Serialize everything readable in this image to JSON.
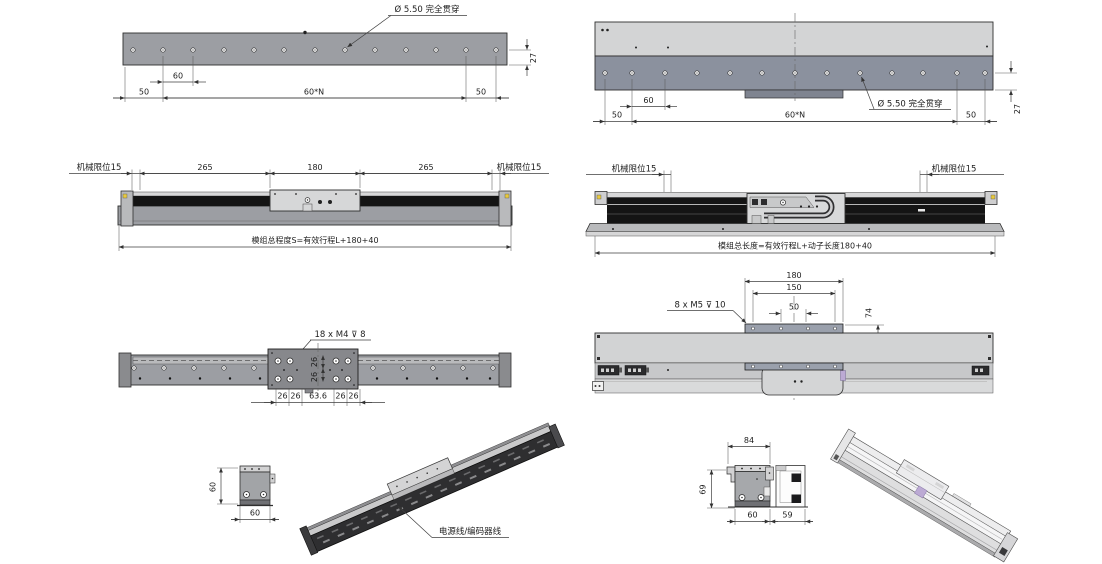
{
  "colors": {
    "body": "#9c9ea3",
    "slate": "#8b919e",
    "light": "#d3d4d5",
    "plate": "#9aa0ac",
    "rail_dark": "#141414",
    "carriage": "#d8d9da",
    "yellow": "#e8c93e",
    "purple": "#bcaad4",
    "iso_dark": "#2e2e30"
  },
  "views": {
    "plan_left": {
      "callout": "Ø 5.50 完全贯穿",
      "dim_pitch": "60",
      "dim_edge_left": "50",
      "dim_total": "60*N",
      "dim_edge_right": "50",
      "dim_height": "27"
    },
    "side_left": {
      "limit_left": "机械限位15",
      "limit_right": "机械限位15",
      "dim_a": "265",
      "dim_b": "180",
      "dim_c": "265",
      "total_note": "模组总程度S=有效行程L+180+40"
    },
    "bottom_left": {
      "callout": "18 x M4 ⊽ 8",
      "dim_1": "26",
      "dim_2": "26",
      "dim_3": "63.6",
      "dim_4": "26",
      "dim_5": "26",
      "dim_v1": "26",
      "dim_v2": "26"
    },
    "end_left": {
      "dim_height": "60",
      "dim_width": "60"
    },
    "iso_left": {
      "callout": "电源线/编码器线"
    },
    "plan_right": {
      "callout": "Ø 5.50 完全贯穿",
      "dim_pitch": "60",
      "dim_edge_left": "50",
      "dim_total": "60*N",
      "dim_edge_right": "50",
      "dim_height": "27"
    },
    "side_right": {
      "limit_left": "机械限位15",
      "limit_right": "机械限位15",
      "total_note": "模组总长度=有效行程L+动子长度180+40"
    },
    "top_right": {
      "callout": "8 x M5 ⊽ 10",
      "dim_plate": "180",
      "dim_span": "150",
      "dim_pitch": "50",
      "dim_height": "74"
    },
    "end_right": {
      "dim_top": "84",
      "dim_height": "69",
      "dim_width_body": "60",
      "dim_width_tray": "59"
    }
  }
}
